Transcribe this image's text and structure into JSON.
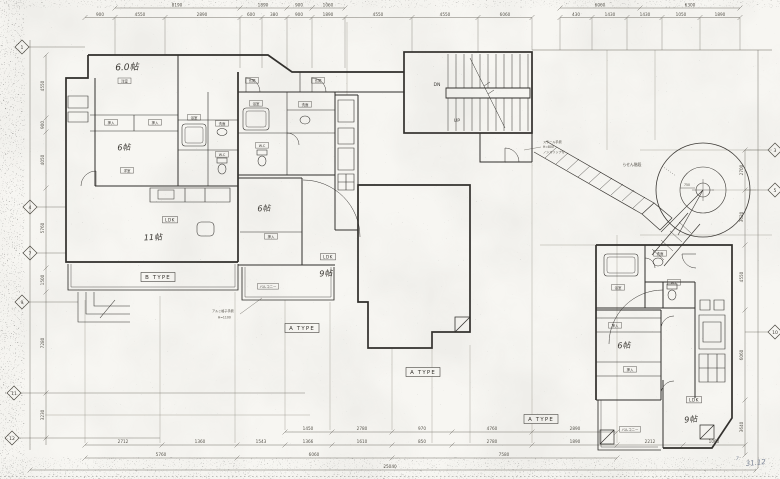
{
  "colors": {
    "paper": "#f7f6f2",
    "ink": "#2e2c29",
    "dim": "#55524a",
    "pencil": "#7b8496"
  },
  "plan": {
    "units": {
      "b": {
        "type_label": "B TYPE",
        "room1_size": "6.0帖",
        "room1_tag": "洋室",
        "room2_size": "6帖",
        "room2_tag": "洋室",
        "closet1": "押入",
        "closet2": "押入",
        "bath": "浴室",
        "wash": "洗面",
        "wc": "W.C",
        "ldk": "LDK",
        "ldk_size": "11帖"
      },
      "m": {
        "type_label": "A TYPE",
        "type_label2": "A TYPE",
        "genkan1": "玄関",
        "genkan2": "玄関",
        "room_size": "6帖",
        "closet": "押入",
        "bath": "浴室",
        "wash": "洗面",
        "wc": "W.C",
        "ldk": "LDK",
        "ldk_size": "9帖",
        "balcony": "バルコニー"
      },
      "r": {
        "type_label": "A TYPE",
        "room_size": "6帖",
        "closet1": "押入",
        "closet2": "押入",
        "bath": "浴室",
        "wash": "洗面",
        "wc": "W.C",
        "ldk": "LDK",
        "ldk_size": "9帖",
        "balcony": "バルコニー"
      }
    },
    "stair": {
      "up": "UP",
      "dn": "DN"
    },
    "spiral": {
      "label": "らせん階段",
      "radius_dim": "750"
    },
    "notes": {
      "stair1": "スチール手摺",
      "stair2": "H=800",
      "stair3": "ノンスリップ付",
      "balcony1": "アルミ格子手摺",
      "balcony2": "H=1100",
      "date": "31.12",
      "date2": "7."
    }
  },
  "grid": {
    "left": [
      "1",
      "4",
      "7",
      "9",
      "11",
      "12"
    ],
    "right": [
      "3",
      "5",
      "10"
    ]
  },
  "dims": {
    "top": [
      "8190",
      "1890",
      "900",
      "1060",
      "6060",
      "6300",
      "900",
      "4550",
      "2890",
      "600",
      "380",
      "900",
      "1890",
      "4550",
      "4550",
      "6060",
      "430",
      "1430",
      "1430",
      "1050",
      "1890"
    ],
    "bottom": [
      "1450",
      "2780",
      "970",
      "4760",
      "2890",
      "2712",
      "1360",
      "1543",
      "1366",
      "1610",
      "850",
      "2780",
      "1890",
      "2212",
      "1060",
      "5760",
      "6060",
      "7580",
      "25040"
    ],
    "left": [
      "4550",
      "900",
      "4050",
      "5760",
      "1500",
      "7280",
      "3230"
    ],
    "right": [
      "2700",
      "3620",
      "4550",
      "6060",
      "3640"
    ]
  }
}
